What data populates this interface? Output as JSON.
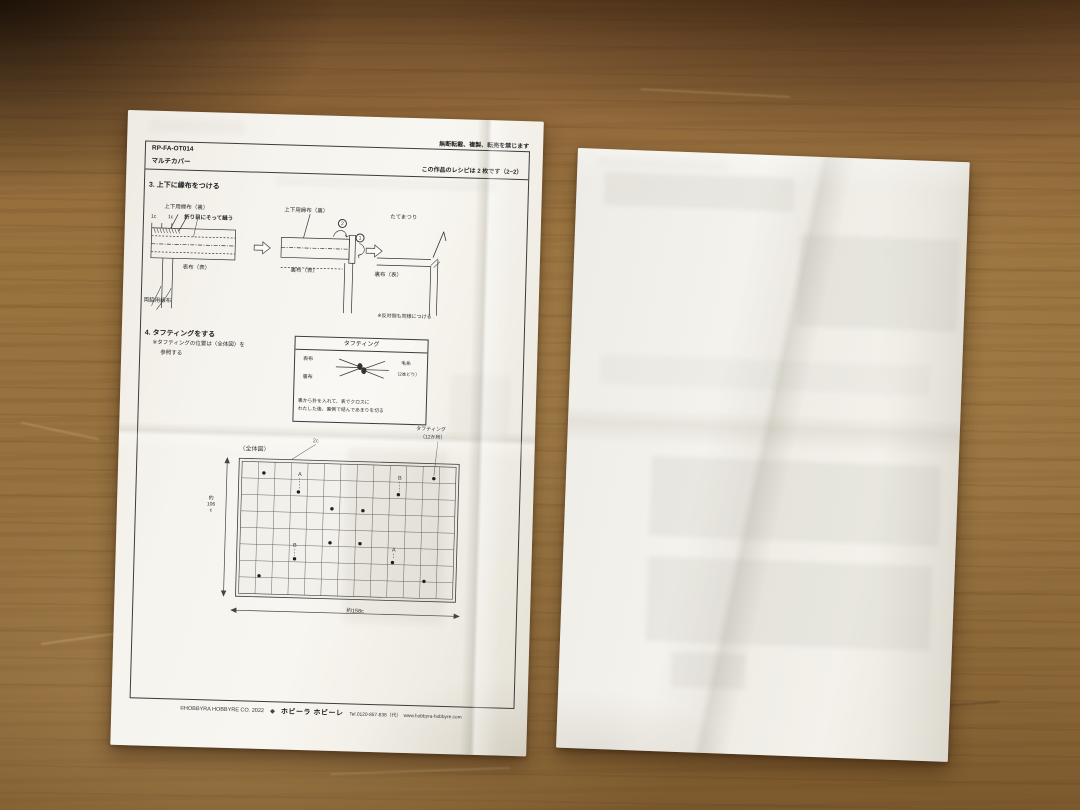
{
  "photo": {
    "surface": "wood-table",
    "wood_color": "#96703c",
    "paper_color": "#f4f2ec"
  },
  "sheet_front": {
    "notice": "無断転載、複製、転売を禁じます",
    "header": {
      "code": "RP-FA-OT014",
      "title": "マルチカバー",
      "recipe_count_note": "この作品のレシピは 2 枚です（2−2）"
    },
    "step3": {
      "heading": "3. 上下に縁布をつける",
      "diagram1": {
        "top_label": "上下用縁布（裏）",
        "dim_left": "1c",
        "dim_right": "1c",
        "sew_note": "折り目にそって縫う",
        "fabric_label": "表布（表）",
        "side_strip_label": "両脇用縁布"
      },
      "diagram2": {
        "top_label": "上下用縁布（裏）",
        "step2_num": "2",
        "step1_num": "1",
        "fabric_label": "裏布（表）"
      },
      "diagram3": {
        "stitch_label": "たてまつり",
        "fabric_label": "裏布（表）",
        "note": "※反対側も同様につける"
      }
    },
    "step4": {
      "heading": "4. タフティングをする",
      "note_line1": "※タフティングの位置は〈全体図〉を",
      "note_line2": "参照する",
      "tufting_box": {
        "title": "タフティング",
        "front_label": "表布",
        "back_label": "裏布",
        "yarn_label": "毛糸",
        "yarn_note": "（2本どり）",
        "caption_line1": "裏から針を入れて、表でクロスに",
        "caption_line2": "わたした後、裏側で結んであまりを切る"
      }
    },
    "overall_diagram": {
      "title": "〈全体図〉",
      "grid_pitch_label": "2c",
      "tufting_count_line1": "タフティング",
      "tufting_count_line2": "（12か所）",
      "height_label_line1": "約",
      "height_label_line2": "106",
      "height_label_line3": "c",
      "width_label": "約158c",
      "grid": {
        "cols": 13,
        "rows": 8,
        "x": 15,
        "y": 26,
        "w": 220,
        "h": 138
      },
      "points": [
        [
          40,
          40
        ],
        [
          210,
          41
        ],
        [
          75,
          58
        ],
        [
          175,
          58
        ],
        [
          109,
          74
        ],
        [
          140,
          75
        ],
        [
          108,
          108
        ],
        [
          138,
          108
        ],
        [
          73,
          125
        ],
        [
          171,
          126
        ],
        [
          38,
          143
        ],
        [
          203,
          144
        ]
      ],
      "letters": [
        {
          "t": "A",
          "x": 76,
          "y": 40,
          "dotY": 58
        },
        {
          "t": "B",
          "x": 176,
          "y": 41,
          "dotY": 58
        },
        {
          "t": "B",
          "x": 73,
          "y": 111,
          "dotY": 125
        },
        {
          "t": "A",
          "x": 172,
          "y": 113,
          "dotY": 126
        }
      ]
    },
    "footer": {
      "copyright": "©HOBBYRA HOBBYRE CO. 2022",
      "brand": "ホビーラ ホビーレ",
      "contact": "Tel.0120-857-838（代）　www.hobbyra-hobbyre.com"
    }
  }
}
